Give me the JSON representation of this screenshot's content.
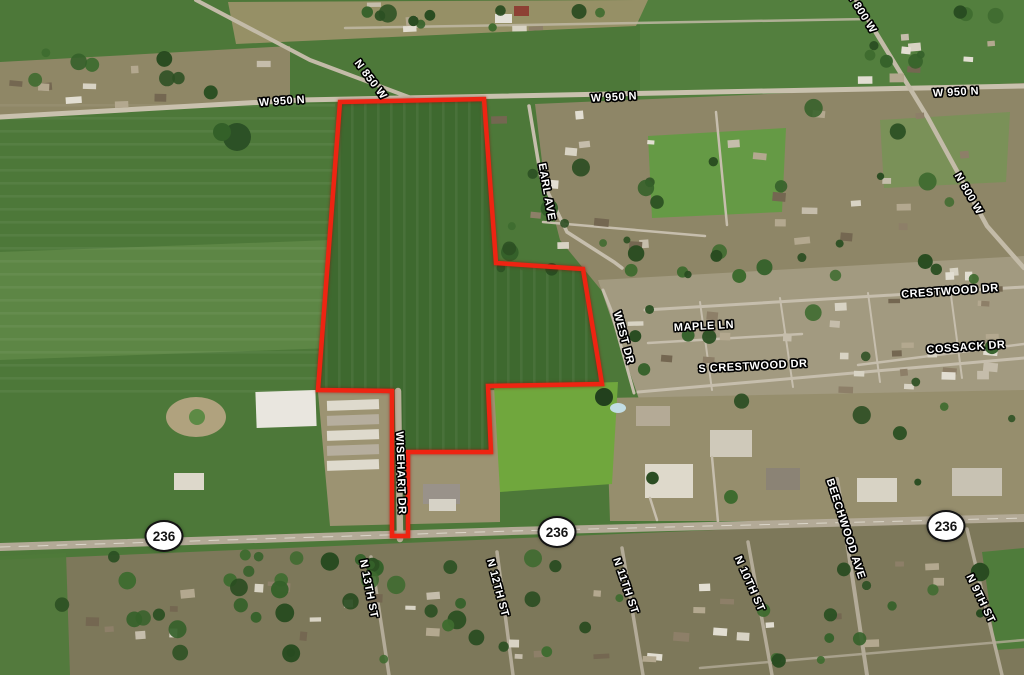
{
  "map": {
    "view": "aerial-satellite",
    "parcel_outline_color": "#ee2412",
    "labels": {
      "w950n_left": "W 950 N",
      "w950n_center": "W 950 N",
      "w950n_right": "W 950 N",
      "n850w": "N 850 W",
      "n800w_top": "N 800 W",
      "n800w_right": "N 800 W",
      "earl_ave": "EARL AVE",
      "crestwood_dr": "CRESTWOOD DR",
      "maple_ln": "MAPLE LN",
      "cossack_dr": "COSSACK DR",
      "s_crestwood_dr": "S CRESTWOOD DR",
      "west_dr": "WEST DR",
      "wisehart_dr": "WISEHART DR",
      "beechwood_ave": "BEECHWOOD AVE",
      "n_13th_st": "N 13TH ST",
      "n_12th_st": "N 12TH ST",
      "n_11th_st": "N 11TH ST",
      "n_10th_st": "N 10TH ST",
      "n_9th_st": "N 9TH ST"
    },
    "highway_shields": {
      "left": "236",
      "center": "236",
      "right": "236"
    }
  }
}
